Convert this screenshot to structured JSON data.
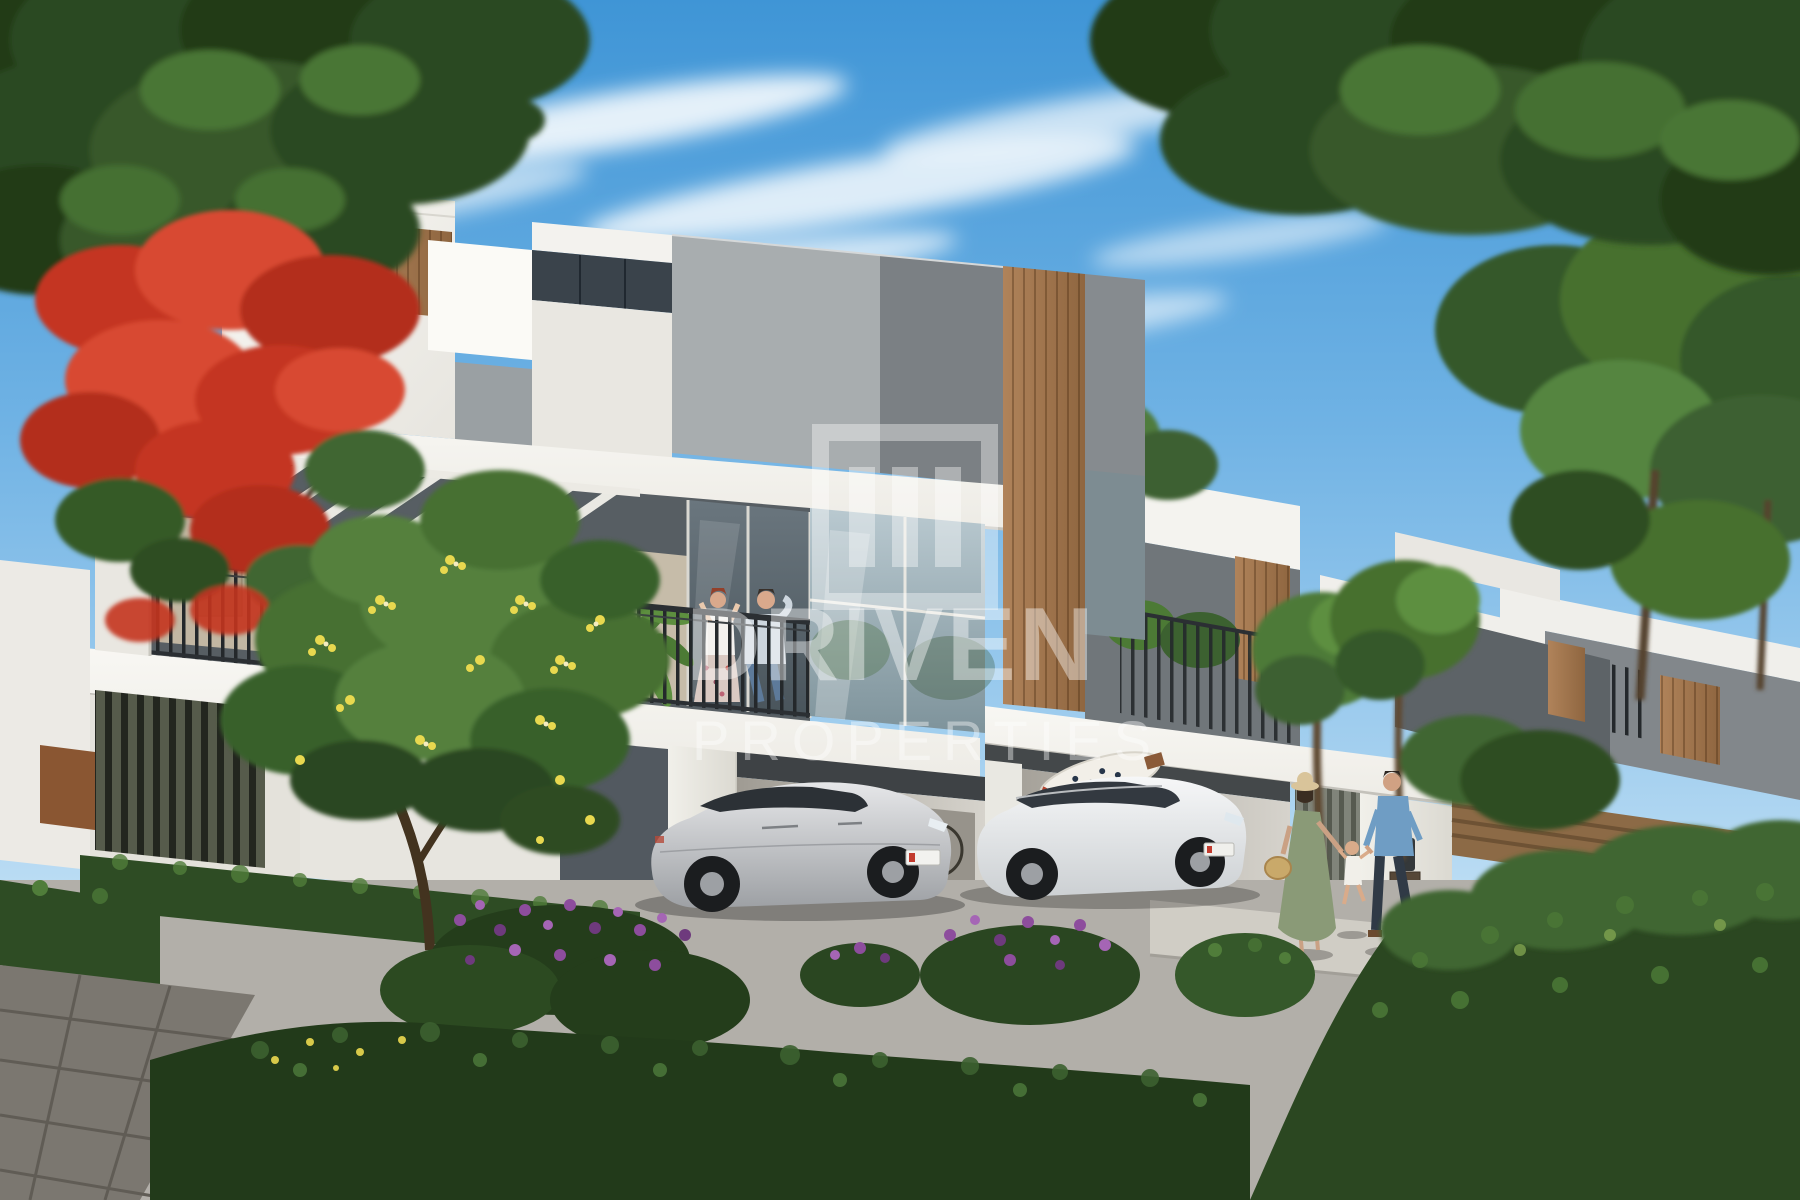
{
  "watermark": {
    "icon": "driven-blinds-square-icon",
    "brand": "DRIVEN",
    "subtitle": "PROPERTIES"
  },
  "villas": [
    {
      "number": "43"
    },
    {
      "number": "45"
    }
  ],
  "palette": {
    "sky_top": "#3f95d6",
    "sky_horizon": "#eaf5fb",
    "wall_white": "#f2f1ed",
    "wall_gray_light": "#a8adaf",
    "wall_gray_dark": "#70767a",
    "wood_accent": "#a27a4f",
    "foliage_dark": "#2c4a21",
    "foliage_light": "#54803d",
    "flowers_red": "#d84830",
    "flowers_yellow": "#e8d84f",
    "flowers_purple": "#8d4d9d",
    "railing_metal": "#24282b",
    "road": "#b2afa9",
    "sedan_silver": "#c9cbce",
    "suv_white": "#eef0f1"
  }
}
